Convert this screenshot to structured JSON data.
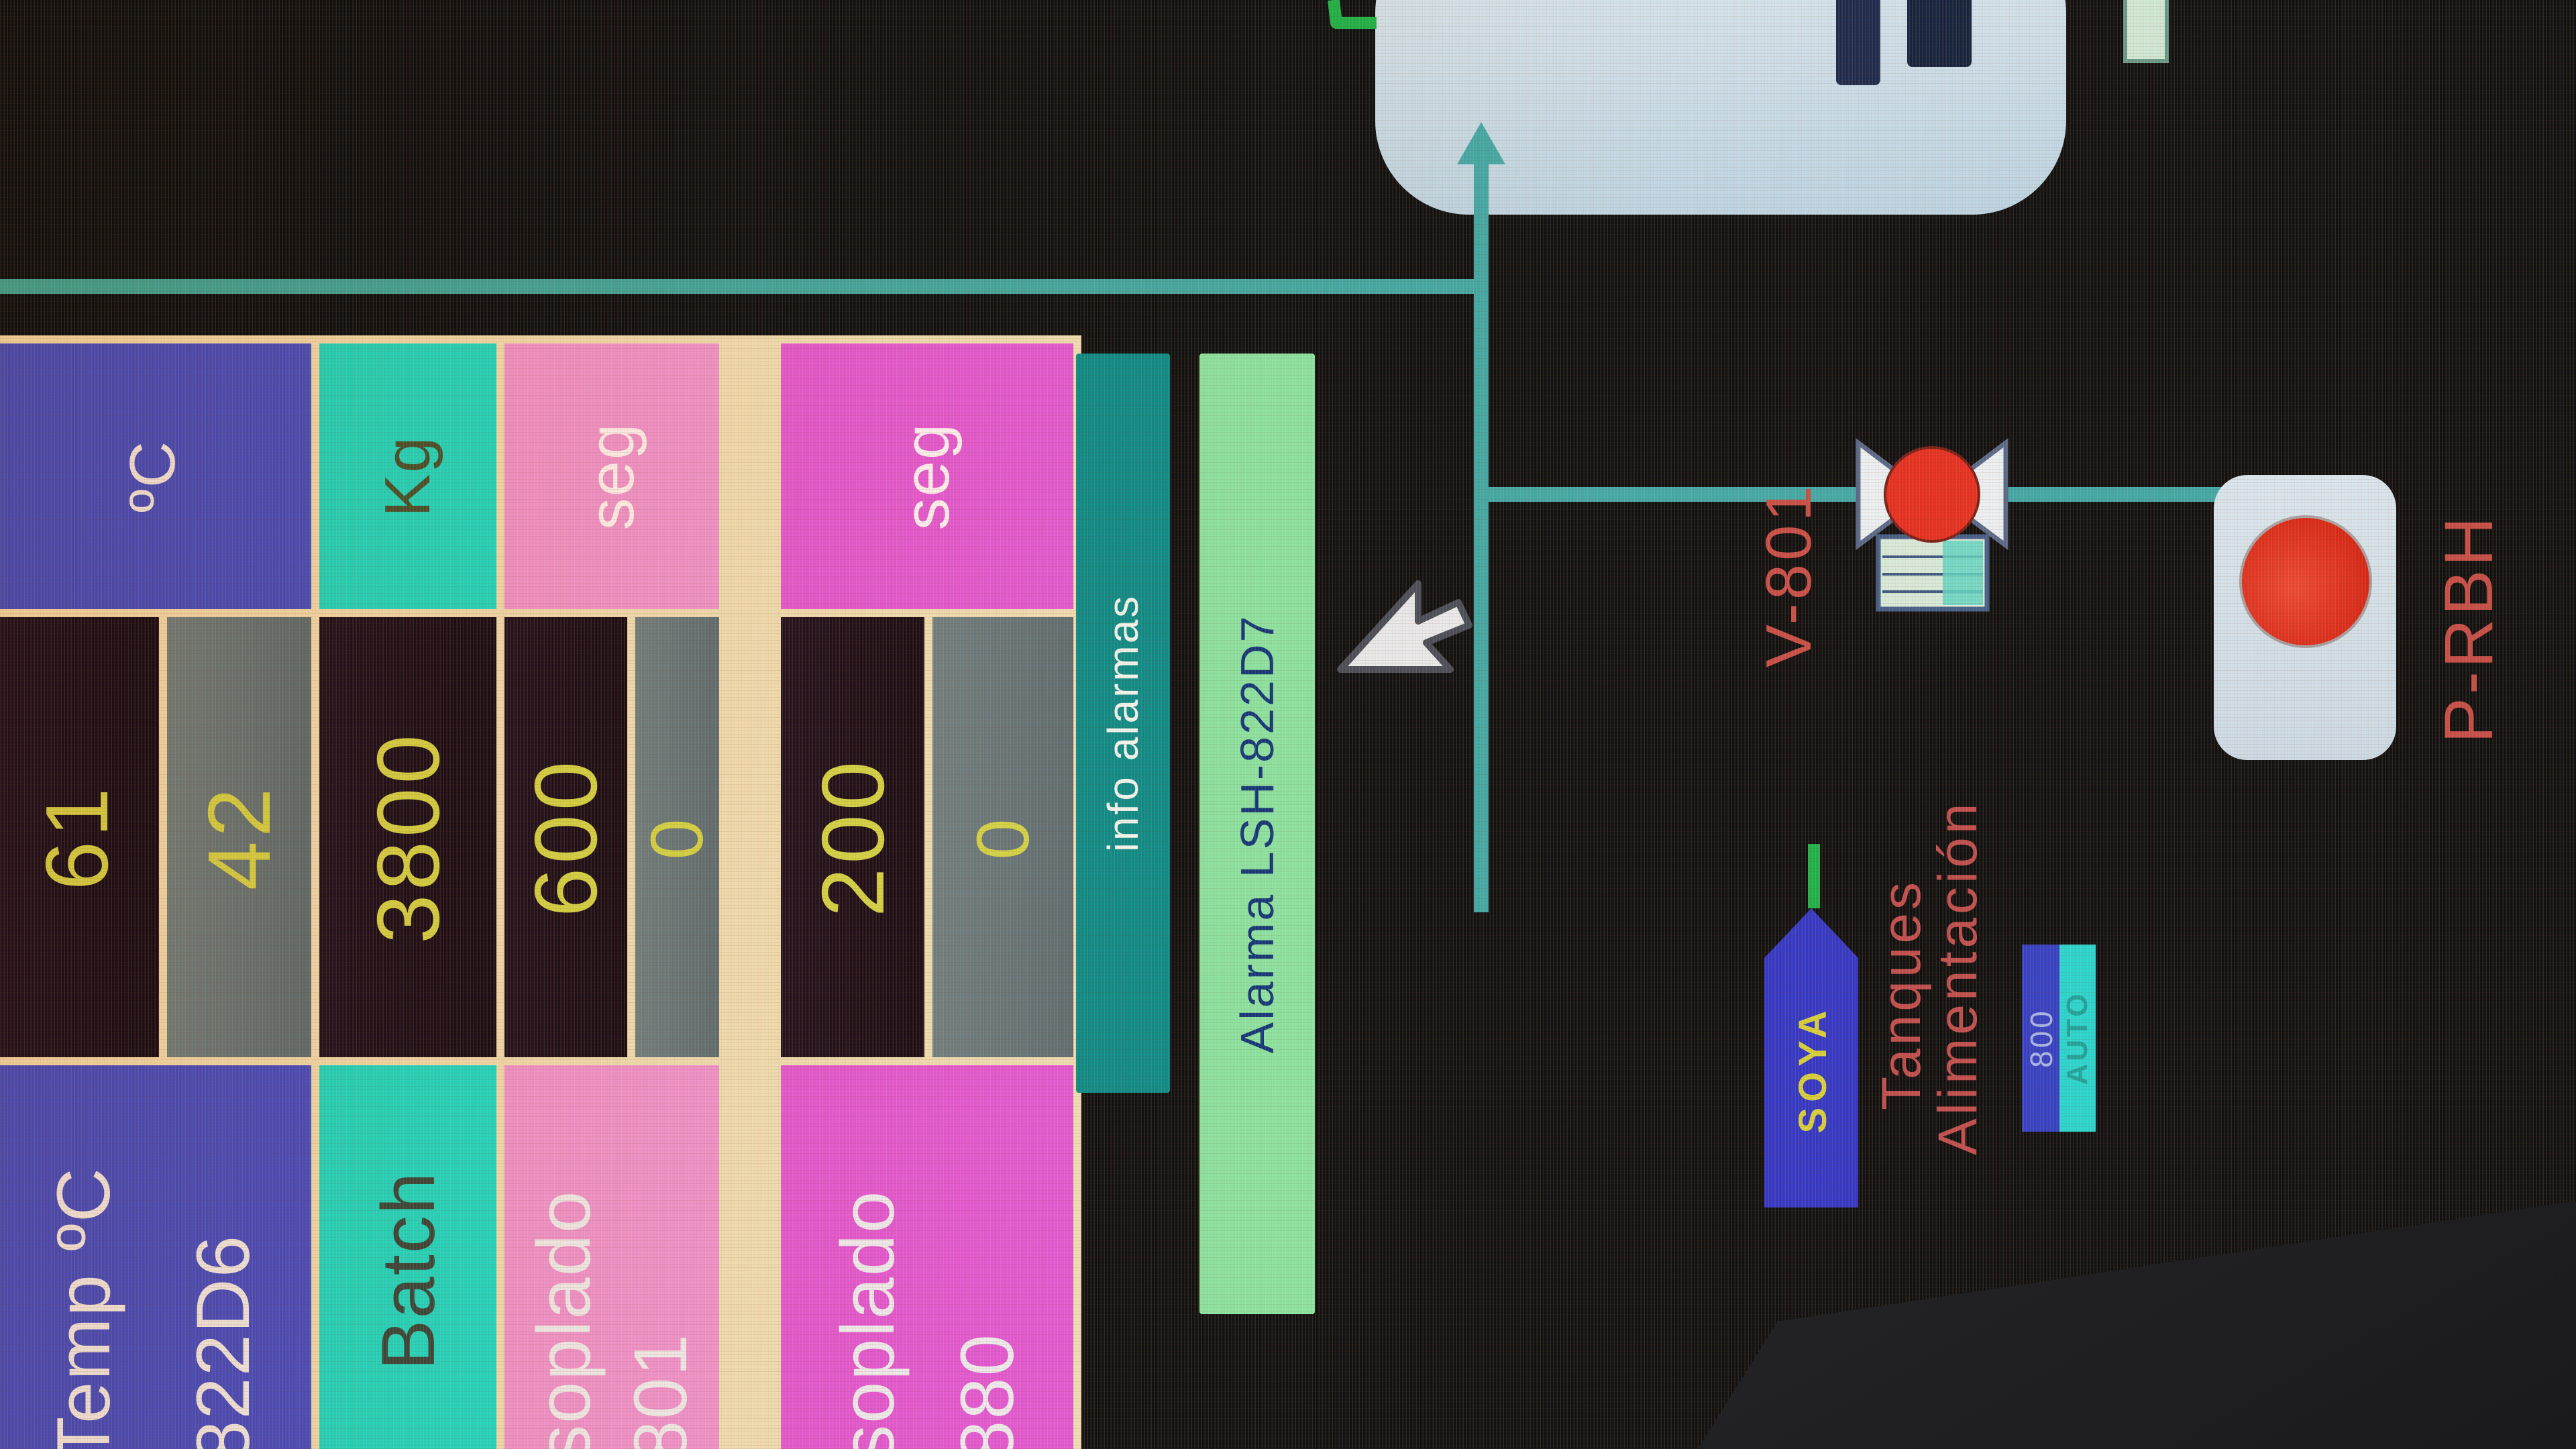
{
  "table": {
    "groups": [
      {
        "label_lines": [
          "Temp ºC",
          "822D6"
        ],
        "unit": "ºC",
        "rows": [
          {
            "value": "61",
            "state": "dark"
          },
          {
            "value": "42",
            "state": "gray"
          }
        ]
      },
      {
        "label_lines": [
          "Batch"
        ],
        "unit": "Kg",
        "rows": [
          {
            "value": "3800",
            "state": "dark"
          }
        ]
      },
      {
        "label_lines": [
          "soplado",
          "801"
        ],
        "unit": "seg",
        "rows": [
          {
            "value": "600",
            "state": "dark"
          },
          {
            "value": "0",
            "state": "gray"
          }
        ]
      },
      {
        "label_lines": [
          "soplado",
          "880"
        ],
        "unit": "seg",
        "rows": [
          {
            "value": "200",
            "state": "dark"
          },
          {
            "value": "0",
            "state": "gray"
          }
        ]
      }
    ]
  },
  "buttons": {
    "info_alarms_label": "info alarmas",
    "alarm_label": "Alarma LSH-822D7"
  },
  "diagram": {
    "valve_label": "V-801",
    "pump_label": "P-RBH",
    "tank_tag": "SOYA",
    "feed_title_line1": "Tanques",
    "feed_title_line2": "Alimentación",
    "unit_number": "800",
    "mode_label": "AUTO"
  },
  "colors": {
    "header_blue": "#4b50d2",
    "cyan": "#25ded2",
    "pink": "#ef97da",
    "magenta": "#e35bdd",
    "value_yellow": "#d3d94b",
    "teal_button": "#0f8e8e",
    "alarm_green": "#8ce6a6",
    "alarm_text_navy": "#14387c",
    "pipe_teal": "#43aaa8",
    "pipe_green": "#1fb34a",
    "device_red": "#e63122",
    "label_red": "#c94f49",
    "tank_blue": "#c8dce9"
  }
}
